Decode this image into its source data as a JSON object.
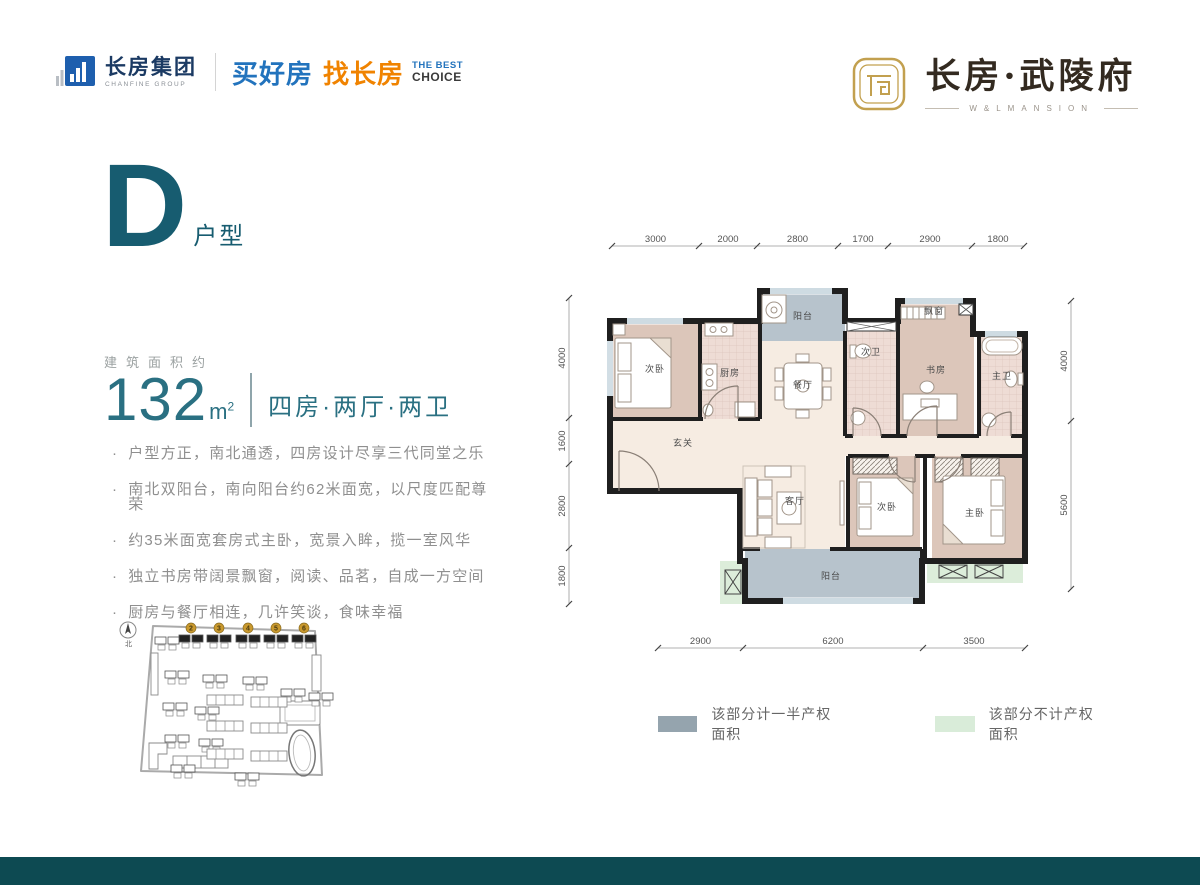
{
  "header": {
    "group": {
      "name": "长房集团",
      "sub": "CHANFINE GROUP"
    },
    "slogan": {
      "buy": "买好房",
      "find": "找长房",
      "best": "THE BEST",
      "choice": "CHOICE"
    },
    "project": {
      "title": "长房·武陵府",
      "subtitle": "W&LMANSION"
    }
  },
  "unit": {
    "letter": "D",
    "suffix": "户型"
  },
  "area": {
    "label": "建筑面积约",
    "value": "132",
    "unit_base": "m",
    "unit_sup": "2",
    "layout": "四房·两厅·两卫"
  },
  "features": [
    "户型方正，南北通透，四房设计尽享三代同堂之乐",
    "南北双阳台，南向阳台约62米面宽，以尺度匹配尊荣",
    "约35米面宽套房式主卧，宽景入眸，揽一室风华",
    "独立书房带阔景飘窗，阅读、品茗，自成一方空间",
    "厨房与餐厅相连，几许笑谈，食味幸福"
  ],
  "siteplan": {
    "compass": "北",
    "highlight_numbers": [
      "2",
      "3",
      "4",
      "5",
      "6"
    ]
  },
  "floorplan": {
    "rooms": [
      "次卧",
      "厨房",
      "阳台",
      "餐厅",
      "次卫",
      "书房",
      "飘窗",
      "主卫",
      "玄关",
      "客厅",
      "次卧",
      "主卧",
      "阳台"
    ],
    "dims_top": [
      "3000",
      "2000",
      "2800",
      "1700",
      "2900",
      "1800"
    ],
    "dims_left": [
      "4000",
      "1600",
      "2800",
      "1800"
    ],
    "dims_right": [
      "4000",
      "5600"
    ],
    "dims_bottom": [
      "2900",
      "6200",
      "3500"
    ]
  },
  "legend": [
    {
      "label": "该部分计一半产权面积",
      "color": "#95a4ae"
    },
    {
      "label": "该部分不计产权面积",
      "color": "#d9ecd9"
    }
  ],
  "colors": {
    "accent_teal": "#175c70",
    "footer_teal": "#0d4a52",
    "gold": "#c9992e",
    "logo_blue": "#2273bd",
    "logo_orange": "#f08300"
  }
}
